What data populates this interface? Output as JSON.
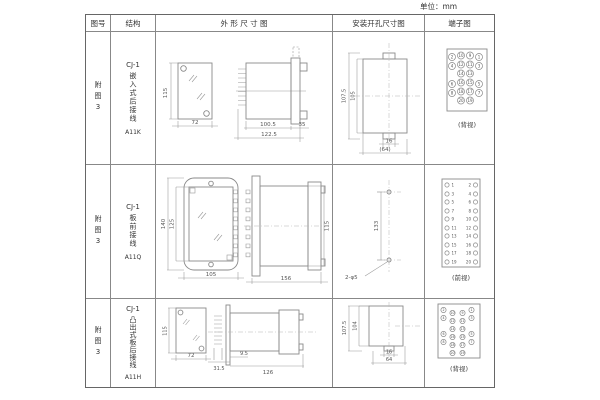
{
  "unit_label": "单位：mm",
  "columns": {
    "fig": "图号",
    "struct": "结构",
    "outline": "外 形 尺 寸 图",
    "mount": "安装开孔尺寸图",
    "terminal": "端子图"
  },
  "rows": [
    {
      "fig": "附图3",
      "model": "CJ-1",
      "mount_type": "嵌入式后接线",
      "code": "A11K",
      "outline": {
        "front_h": "115",
        "front_w": "72",
        "body_l": "100.5",
        "flange_l": "35",
        "total_l": "122.5"
      },
      "mount": {
        "outer_h": "107.5",
        "inner_h": "105",
        "w_small": "16",
        "w_large": "(64)"
      },
      "terminal": {
        "view": "(背视)",
        "grid": [
          [
            "2",
            "10",
            "9",
            "1"
          ],
          [
            "4",
            "12",
            "11",
            "3"
          ],
          [
            "",
            "14",
            "13",
            ""
          ],
          [
            "6",
            "16",
            "15",
            "5"
          ],
          [
            "8",
            "18",
            "17",
            "7"
          ],
          [
            "",
            "20",
            "19",
            ""
          ]
        ]
      }
    },
    {
      "fig": "附图3",
      "model": "CJ-1",
      "mount_type": "板前接线",
      "code": "A11Q",
      "outline": {
        "front_h": "140",
        "inner_h": "125",
        "front_w": "105",
        "side_l": "156",
        "side_h": "115"
      },
      "mount": {
        "hole_pitch": "133",
        "holes": "2-φ5"
      },
      "terminal": {
        "view": "(前视)",
        "left": [
          "1",
          "3",
          "5",
          "7",
          "9",
          "11",
          "13",
          "15",
          "17",
          "19"
        ],
        "right": [
          "2",
          "4",
          "6",
          "8",
          "10",
          "12",
          "14",
          "16",
          "18",
          "20"
        ]
      }
    },
    {
      "fig": "附图3",
      "model": "CJ-1",
      "mount_type": "凸出式板后接线",
      "code": "A11H",
      "outline": {
        "front_h": "115",
        "front_w": "72",
        "fin_l": "31.5",
        "offset": "9.5",
        "body_l": "126"
      },
      "mount": {
        "outer_h": "107.5",
        "inner_h": "104",
        "w_small": "16",
        "w_large": "64"
      },
      "terminal": {
        "view": "(背视)",
        "grid": [
          [
            "2",
            "10",
            "9",
            "1"
          ],
          [
            "4",
            "12",
            "11",
            "3"
          ],
          [
            "",
            "14",
            "13",
            ""
          ],
          [
            "6",
            "16",
            "15",
            "5"
          ],
          [
            "8",
            "18",
            "17",
            "7"
          ],
          [
            "",
            "20",
            "19",
            ""
          ]
        ]
      }
    }
  ]
}
